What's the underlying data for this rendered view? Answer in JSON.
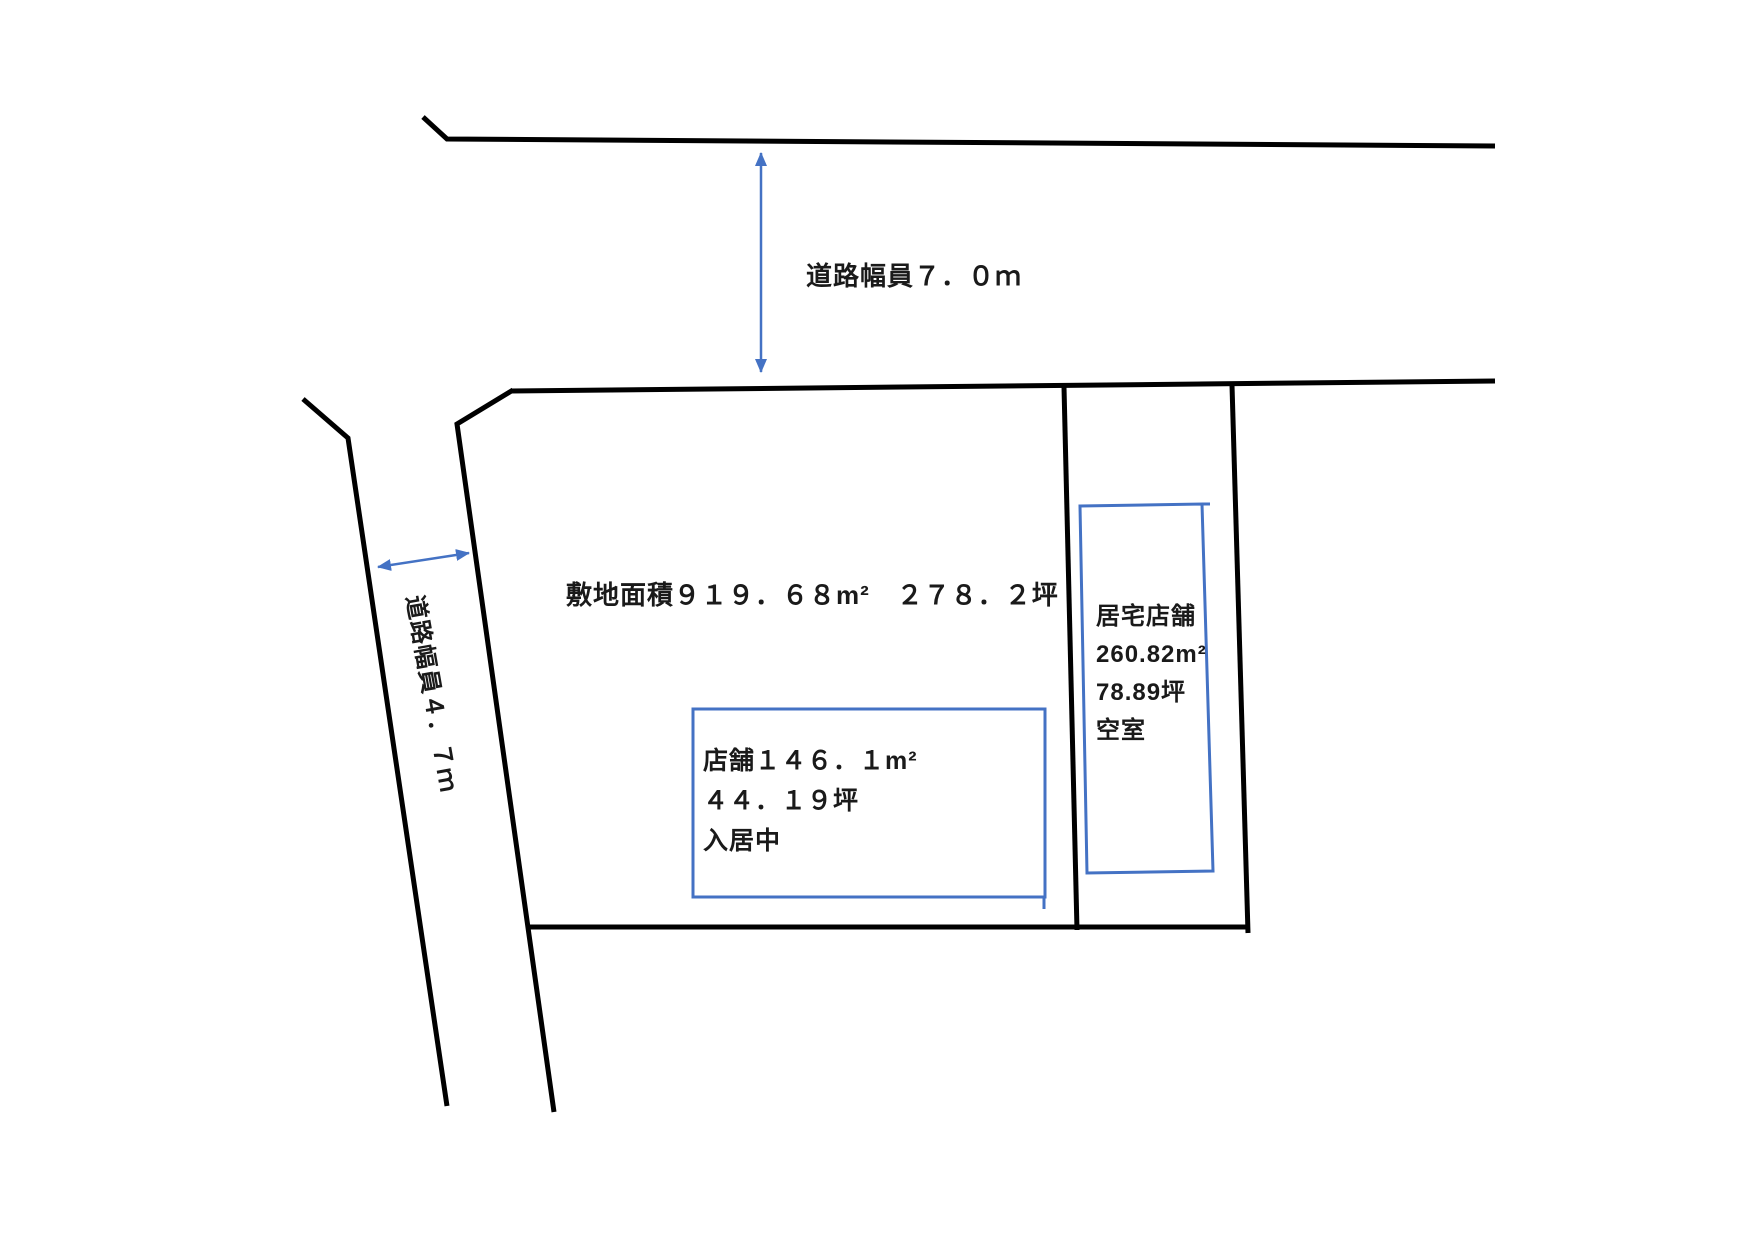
{
  "diagram": {
    "road_top": {
      "width_label": "道路幅員７．０ｍ"
    },
    "road_left": {
      "width_label": "道路幅員４．７ｍ"
    },
    "site": {
      "area_label": "敷地面積９１９．６８m²　２７８．２坪"
    },
    "tenant_box": {
      "line1": "店舗１４６．１m²",
      "line2": "４４．１９坪",
      "line3": "入居中"
    },
    "residence_box": {
      "line1": "居宅店舗",
      "line2": "260.82m²",
      "line3": "78.89坪",
      "line4": "空室"
    },
    "colors": {
      "line": "#000000",
      "accent": "#4472C4"
    }
  }
}
